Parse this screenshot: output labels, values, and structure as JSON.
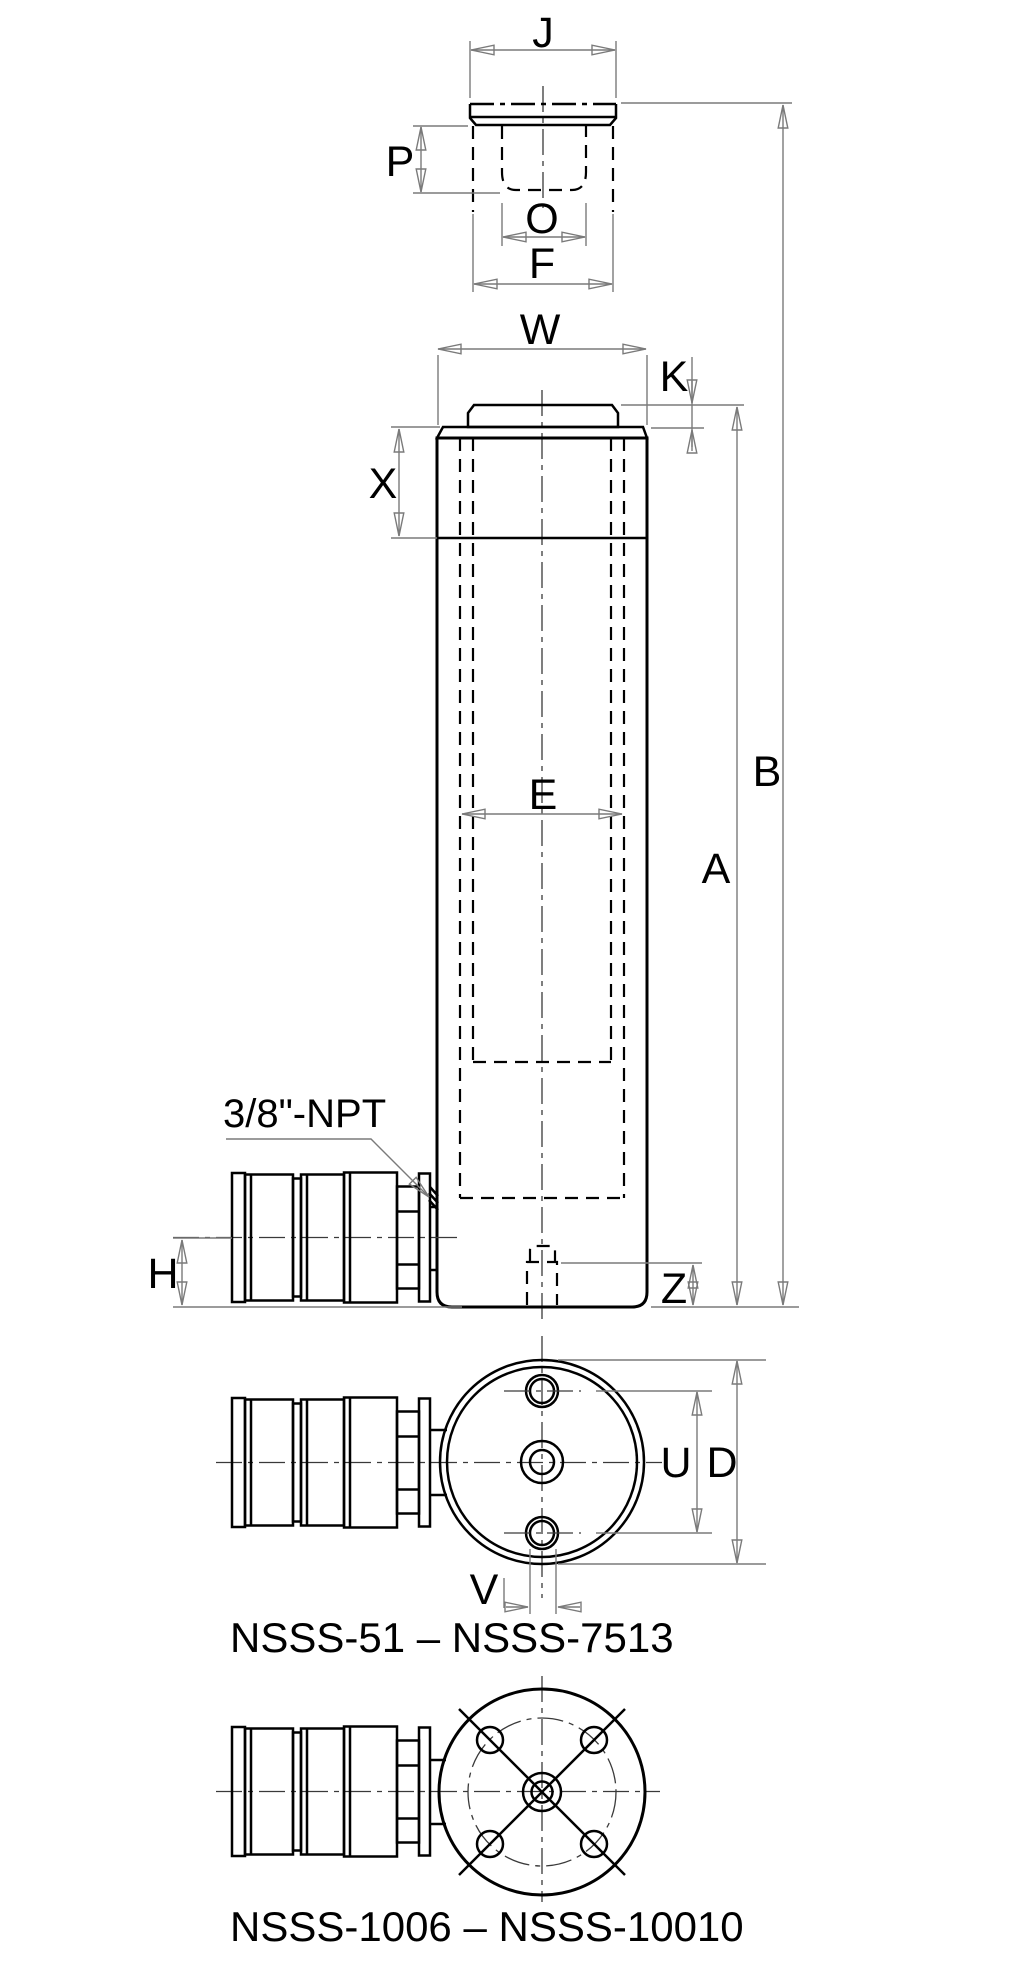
{
  "dims": {
    "j": "J",
    "p": "P",
    "o": "O",
    "f": "F",
    "w": "W",
    "k": "K",
    "x": "X",
    "e": "E",
    "b": "B",
    "a": "A",
    "h": "H",
    "z": "Z",
    "u": "U",
    "d": "D",
    "v": "V"
  },
  "port": {
    "label": "3/8\"-NPT"
  },
  "captions": {
    "small_models": "NSSS-51 – NSSS-7513",
    "large_models": "NSSS-1006 – NSSS-10010"
  },
  "colors": {
    "object_line": "#000000",
    "dimension_line": "#7a7a7a",
    "background": "#ffffff"
  }
}
